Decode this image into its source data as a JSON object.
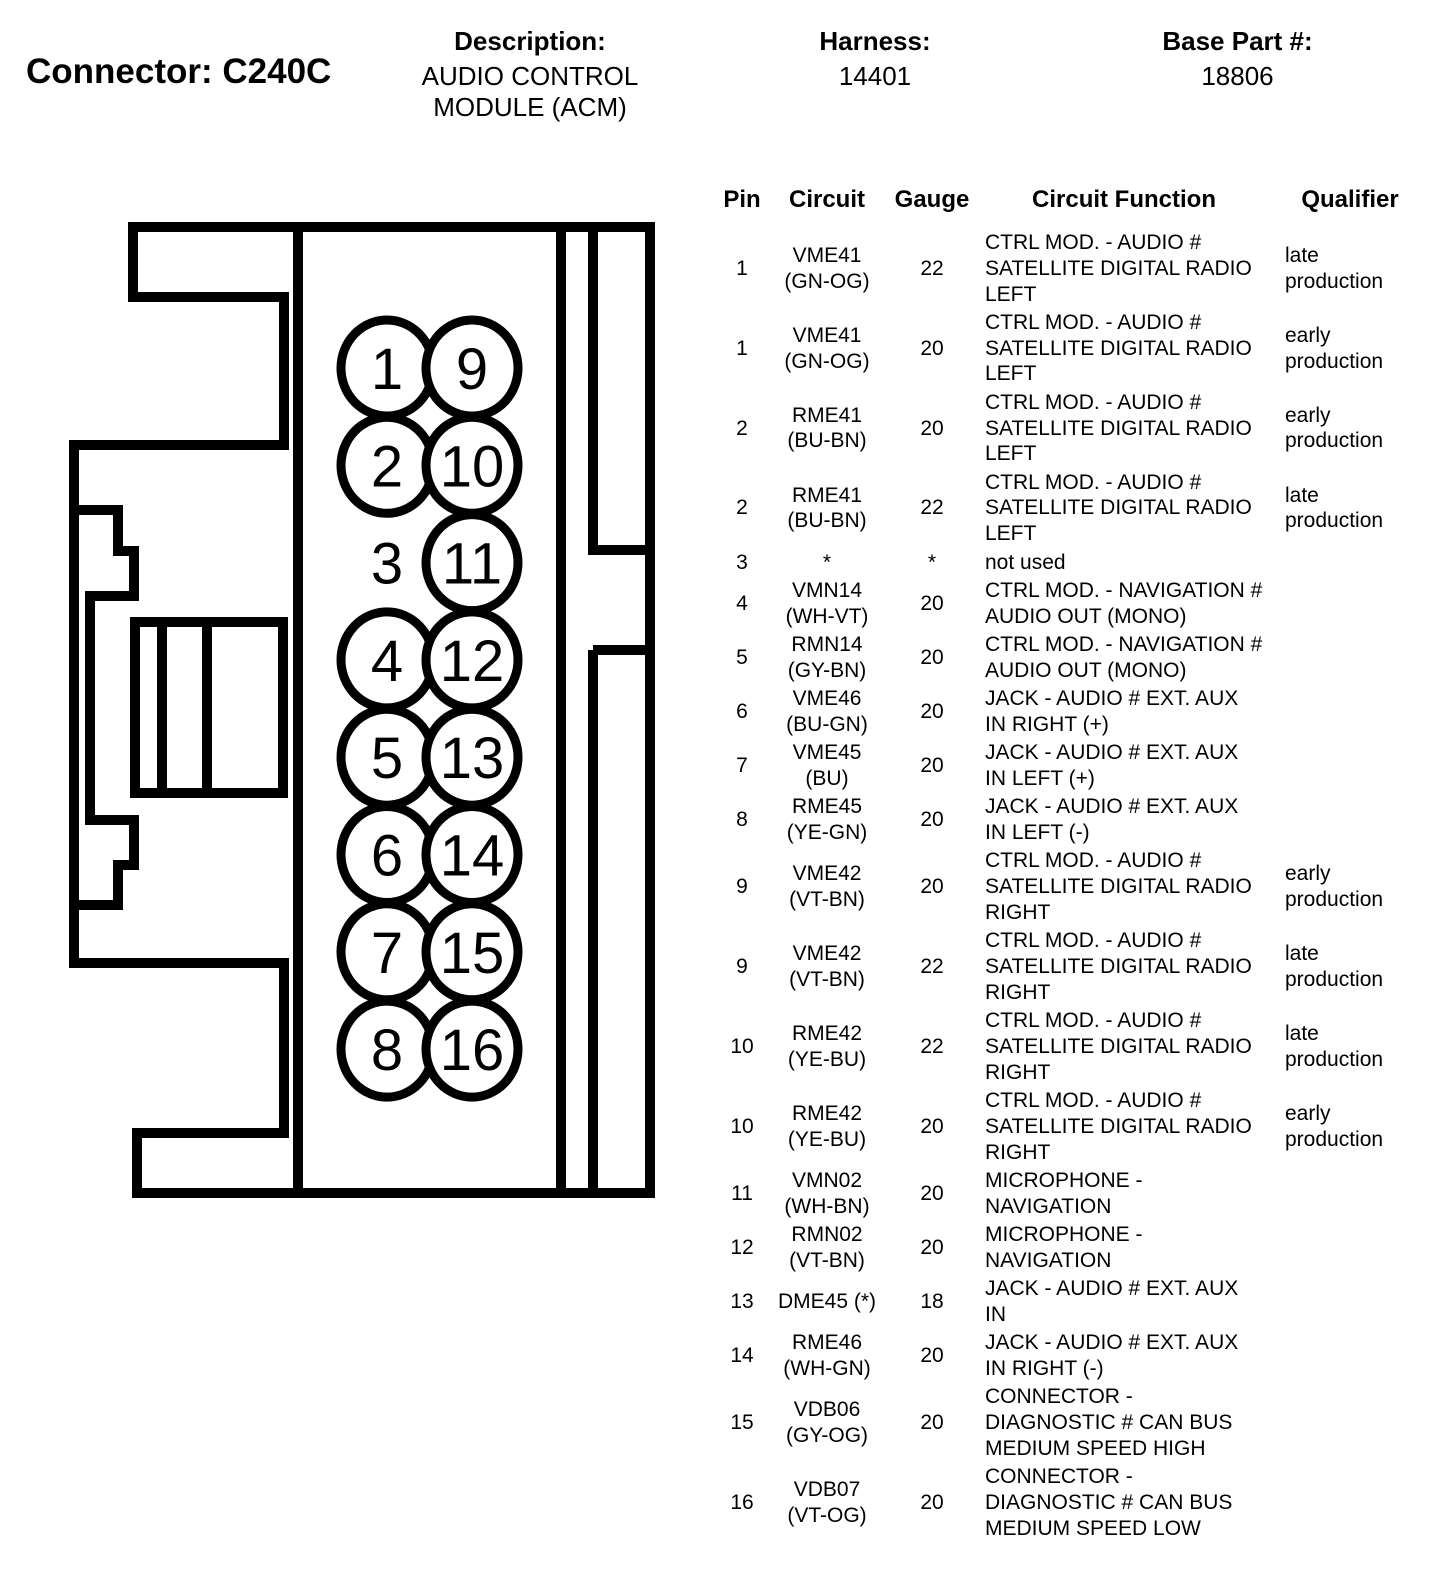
{
  "header": {
    "connector_label": "Connector: C240C",
    "description_label": "Description:",
    "description_value": "AUDIO CONTROL\nMODULE (ACM)",
    "harness_label": "Harness:",
    "harness_value": "14401",
    "base_part_label": "Base Part #:",
    "base_part_value": "18806"
  },
  "connector_diagram": {
    "pins_left_column": [
      "1",
      "2",
      "3",
      "4",
      "5",
      "6",
      "7",
      "8"
    ],
    "pins_right_column": [
      "9",
      "10",
      "11",
      "12",
      "13",
      "14",
      "15",
      "16"
    ],
    "unused_pin_without_cavity": "3",
    "line_color": "#000000",
    "background_color": "#ffffff"
  },
  "pin_table": {
    "columns": [
      "Pin",
      "Circuit",
      "Gauge",
      "Circuit Function",
      "Qualifier"
    ],
    "rows": [
      {
        "pin": "1",
        "circuit": "VME41\n(GN-OG)",
        "gauge": "22",
        "function": "CTRL MOD. - AUDIO #\nSATELLITE DIGITAL RADIO\nLEFT",
        "qualifier": "late\nproduction"
      },
      {
        "pin": "1",
        "circuit": "VME41\n(GN-OG)",
        "gauge": "20",
        "function": "CTRL MOD. - AUDIO #\nSATELLITE DIGITAL RADIO\nLEFT",
        "qualifier": "early\nproduction"
      },
      {
        "pin": "2",
        "circuit": "RME41\n(BU-BN)",
        "gauge": "20",
        "function": "CTRL MOD. - AUDIO #\nSATELLITE DIGITAL RADIO\nLEFT",
        "qualifier": "early\nproduction"
      },
      {
        "pin": "2",
        "circuit": "RME41\n(BU-BN)",
        "gauge": "22",
        "function": "CTRL MOD. - AUDIO #\nSATELLITE DIGITAL RADIO\nLEFT",
        "qualifier": "late\nproduction"
      },
      {
        "pin": "3",
        "circuit": "*",
        "gauge": "*",
        "function": "not used",
        "qualifier": ""
      },
      {
        "pin": "4",
        "circuit": "VMN14\n(WH-VT)",
        "gauge": "20",
        "function": "CTRL MOD. - NAVIGATION #\nAUDIO OUT (MONO)",
        "qualifier": ""
      },
      {
        "pin": "5",
        "circuit": "RMN14\n(GY-BN)",
        "gauge": "20",
        "function": "CTRL MOD. - NAVIGATION #\nAUDIO OUT (MONO)",
        "qualifier": ""
      },
      {
        "pin": "6",
        "circuit": "VME46\n(BU-GN)",
        "gauge": "20",
        "function": "JACK - AUDIO # EXT. AUX\nIN RIGHT (+)",
        "qualifier": ""
      },
      {
        "pin": "7",
        "circuit": "VME45\n(BU)",
        "gauge": "20",
        "function": "JACK - AUDIO # EXT. AUX\nIN LEFT (+)",
        "qualifier": ""
      },
      {
        "pin": "8",
        "circuit": "RME45\n(YE-GN)",
        "gauge": "20",
        "function": "JACK - AUDIO # EXT. AUX\nIN LEFT (-)",
        "qualifier": ""
      },
      {
        "pin": "9",
        "circuit": "VME42\n(VT-BN)",
        "gauge": "20",
        "function": "CTRL MOD. - AUDIO #\nSATELLITE DIGITAL RADIO\nRIGHT",
        "qualifier": "early\nproduction"
      },
      {
        "pin": "9",
        "circuit": "VME42\n(VT-BN)",
        "gauge": "22",
        "function": "CTRL MOD. - AUDIO #\nSATELLITE DIGITAL RADIO\nRIGHT",
        "qualifier": "late\nproduction"
      },
      {
        "pin": "10",
        "circuit": "RME42\n(YE-BU)",
        "gauge": "22",
        "function": "CTRL MOD. - AUDIO #\nSATELLITE DIGITAL RADIO\nRIGHT",
        "qualifier": "late\nproduction"
      },
      {
        "pin": "10",
        "circuit": "RME42\n(YE-BU)",
        "gauge": "20",
        "function": "CTRL MOD. - AUDIO #\nSATELLITE DIGITAL RADIO\nRIGHT",
        "qualifier": "early\nproduction"
      },
      {
        "pin": "11",
        "circuit": "VMN02\n(WH-BN)",
        "gauge": "20",
        "function": "MICROPHONE -\nNAVIGATION",
        "qualifier": ""
      },
      {
        "pin": "12",
        "circuit": "RMN02\n(VT-BN)",
        "gauge": "20",
        "function": "MICROPHONE -\nNAVIGATION",
        "qualifier": ""
      },
      {
        "pin": "13",
        "circuit": "DME45 (*)",
        "gauge": "18",
        "function": "JACK - AUDIO # EXT. AUX\nIN",
        "qualifier": ""
      },
      {
        "pin": "14",
        "circuit": "RME46\n(WH-GN)",
        "gauge": "20",
        "function": "JACK - AUDIO # EXT. AUX\nIN RIGHT (-)",
        "qualifier": ""
      },
      {
        "pin": "15",
        "circuit": "VDB06\n(GY-OG)",
        "gauge": "20",
        "function": "CONNECTOR -\nDIAGNOSTIC # CAN BUS\nMEDIUM SPEED HIGH",
        "qualifier": ""
      },
      {
        "pin": "16",
        "circuit": "VDB07\n(VT-OG)",
        "gauge": "20",
        "function": "CONNECTOR -\nDIAGNOSTIC # CAN BUS\nMEDIUM SPEED LOW",
        "qualifier": ""
      }
    ]
  }
}
